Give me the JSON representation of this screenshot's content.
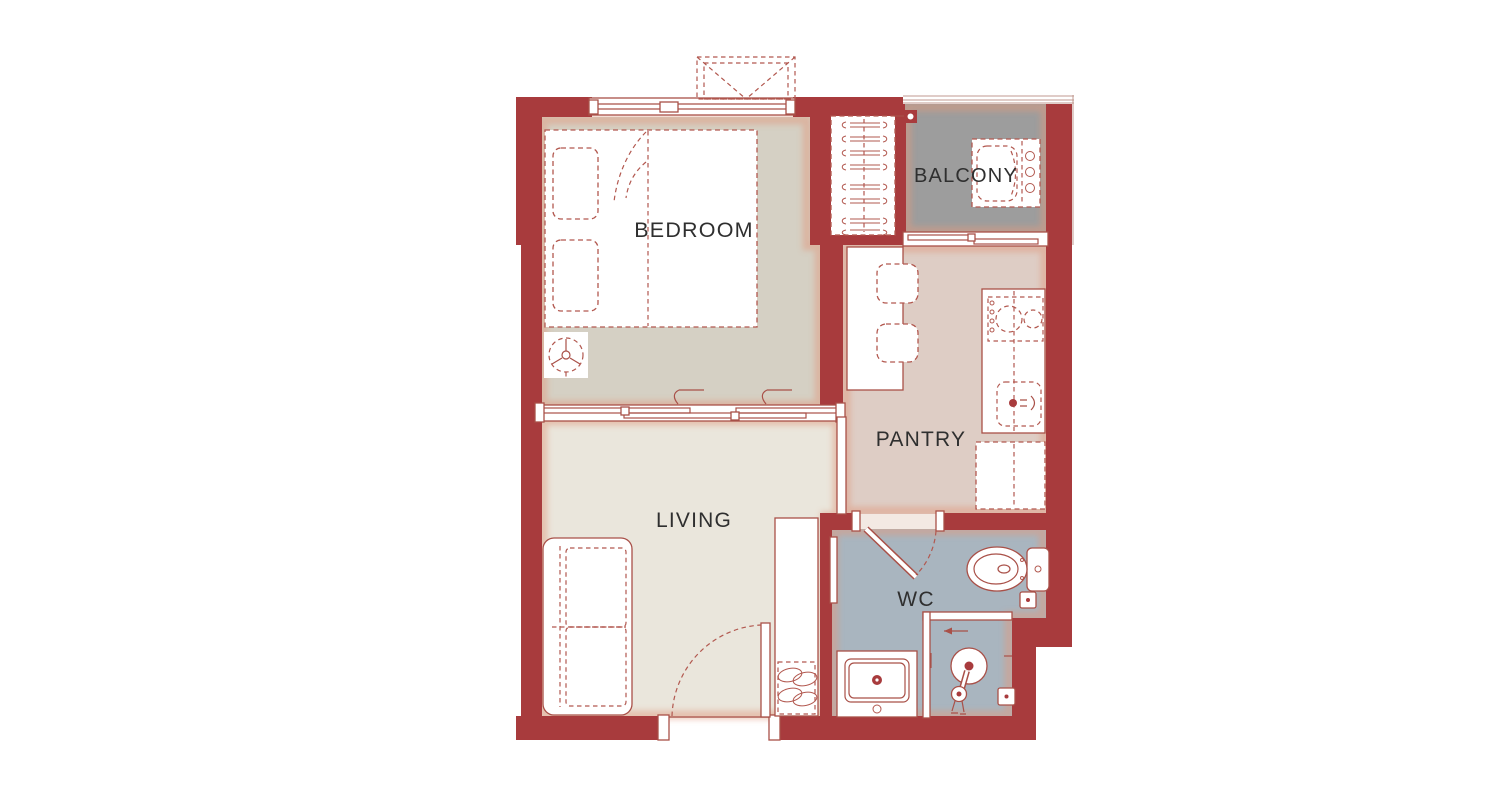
{
  "plan": {
    "type": "apartment-floor-plan",
    "colors": {
      "wall": "#a83b3d",
      "line": "#b2584f",
      "background": "#ffffff"
    },
    "rooms": [
      {
        "id": "bedroom",
        "label": "BEDROOM",
        "floor_color": "#d5d0c4"
      },
      {
        "id": "balcony",
        "label": "BALCONY",
        "floor_color": "#9d9d9d"
      },
      {
        "id": "pantry",
        "label": "PANTRY",
        "floor_color": "#decdc5"
      },
      {
        "id": "living",
        "label": "LIVING",
        "floor_color": "#eae6dc"
      },
      {
        "id": "wc",
        "label": "WC",
        "floor_color": "#a9b5bf"
      }
    ],
    "furniture": [
      "bed",
      "pillows",
      "blanket-fold",
      "ceiling-fan",
      "wardrobe-hangers",
      "washing-machine",
      "balcony-drain-light",
      "dining-table",
      "chairs",
      "kitchen-counter",
      "stove-burners",
      "kitchen-sink",
      "refrigerator",
      "sofa",
      "entry-door",
      "shoe-cabinet",
      "shoes",
      "toilet",
      "vanity-sink",
      "rain-shower",
      "hand-shower",
      "floor-drains",
      "wc-door",
      "shower-partition",
      "towel-rail",
      "sliding-partition",
      "pantry-door",
      "balcony-sliding-door",
      "bedroom-window",
      "balcony-railing",
      "ac-condenser-unit"
    ]
  }
}
